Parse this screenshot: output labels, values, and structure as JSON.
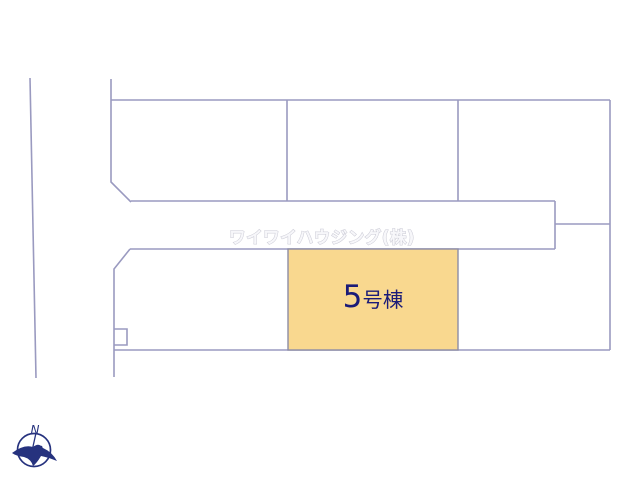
{
  "map": {
    "line_color": "#9a9ac0",
    "background_color": "#ffffff",
    "watermark": {
      "text": "ワイワイハウジング(株)",
      "outline_color": "#c9c9d4",
      "fill_color": "#f7f7fa"
    },
    "highlighted_plot": {
      "label": "5号棟",
      "label_number": "5",
      "label_suffix": "号棟",
      "fill_color": "#F9D88F",
      "border_color": "#8d8da6",
      "text_color": "#1b1b78"
    },
    "compass": {
      "north_label": "N",
      "color": "#26327e"
    }
  }
}
